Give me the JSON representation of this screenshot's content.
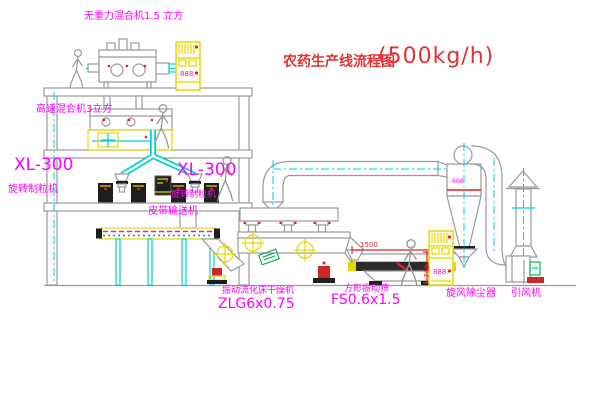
{
  "title": {
    "name": "农药生产线流程图",
    "capacity": "(500kg/h)"
  },
  "labels": {
    "gravity_mixer": "无重力混合机1.5 立方",
    "high_speed_mixer": "高速混合机3立方",
    "granulator_left_model": "XL-300",
    "granulator_left_name": "旋转制粒机",
    "granulator_mid_model": "XL-300",
    "granulator_mid_name": "旋转制粒机",
    "belt_conveyor": "皮带输送机",
    "dryer_name": "振动流化床干燥机",
    "dryer_model": "ZLG6x0.75",
    "screen_name": "方形振动筛",
    "screen_model": "FS0.6x1.5",
    "cyclone": "旋风除尘器",
    "fan": "引风机"
  },
  "dimensions": {
    "screen_length": "1500",
    "screen_height": "741"
  },
  "markings": {
    "cyclone_mark": "600",
    "cabinet_display": "888"
  },
  "colors": {
    "label_magenta": "#ff00ff",
    "title_red": "#e03333",
    "dimension_red": "#dd2222",
    "pipe_cyan": "#00d2d2",
    "equipment_yellow": "#e6d800",
    "structure_gray": "#9a9a9a",
    "accent_green": "#00a550",
    "background": "#ffffff"
  }
}
